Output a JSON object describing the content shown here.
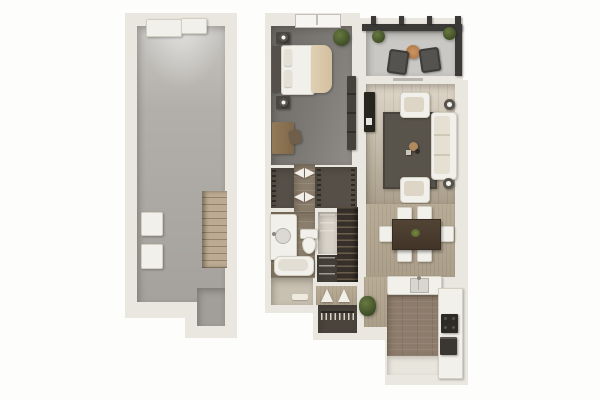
{
  "image": {
    "type": "3d-floor-plan-rendering",
    "background": "#fdfdfb",
    "visible_text": "",
    "units_shown": 2
  },
  "palette": {
    "wall": "#eae7e0",
    "wall_edge": "#c8c5bd",
    "garage_floor": "#a8a5a0",
    "bedroom_carpet": "#7d7a76",
    "balcony_floor": "#c9c8c4",
    "living_wood_floor": "#cfc5b2",
    "dining_floor": "#b3a691",
    "kitchen_floor": "#8d7c6b",
    "bathroom_tile": "#8b7d6b",
    "hall_floor": "#c8c0b1",
    "closet_floor": "#554f48",
    "area_rug": "#58534b",
    "pergola_dark": "#3b3a37",
    "garage_stairs_wood": "#b5a48c",
    "unit_stairs_dark": "#37302a",
    "white_furniture": "#f2f0ea",
    "dark_furniture": "#3f3b36",
    "dining_table_wood": "#4a3d30",
    "plant_green": "#4a5a30",
    "patio_table_accent": "#c38a56",
    "bed_blanket": "#d8c6a7"
  },
  "blocks": [
    {
      "label": "garage",
      "rooms": [
        {
          "label": "garage",
          "furniture": [
            "garage-door-panels",
            "water-heater-box",
            "storage-box",
            "wood-stairs"
          ]
        }
      ]
    },
    {
      "label": "apartment-unit",
      "rooms": [
        {
          "label": "bedroom",
          "furniture": [
            "queen-bed",
            "headboard",
            "nightstand-with-lamp-x2",
            "wardrobe",
            "desk",
            "desk-chair",
            "plant",
            "window"
          ]
        },
        {
          "label": "balcony",
          "furniture": [
            "pergola-beams",
            "railing",
            "patio-chair-x2",
            "round-patio-table",
            "potted-plant-x2"
          ]
        },
        {
          "label": "living-room",
          "furniture": [
            "sofa",
            "armchair-x2",
            "area-rug",
            "floor-lamp-x2",
            "tv-console",
            "coffee-table-set"
          ]
        },
        {
          "label": "dining-area",
          "furniture": [
            "dining-table",
            "dining-chair-x6",
            "green-centerpiece"
          ]
        },
        {
          "label": "kitchen",
          "furniture": [
            "island-with-sink",
            "counter-run",
            "stove",
            "lower-appliance"
          ]
        },
        {
          "label": "closet",
          "furniture": [
            "hanging-rod"
          ]
        },
        {
          "label": "walk-in-closet",
          "furniture": [
            "hanging-rods"
          ]
        },
        {
          "label": "linen-closet",
          "furniture": [
            "shelves"
          ]
        },
        {
          "label": "bathroom",
          "furniture": [
            "vanity-with-sink",
            "toilet",
            "bathtub",
            "bathmat"
          ]
        },
        {
          "label": "hallway",
          "furniture": [
            "coat-closet-with-hangers",
            "double-doors",
            "plant"
          ]
        },
        {
          "label": "stairs",
          "furniture": [
            "under-stair-storage"
          ]
        },
        {
          "label": "entry",
          "furniture": []
        }
      ]
    }
  ]
}
